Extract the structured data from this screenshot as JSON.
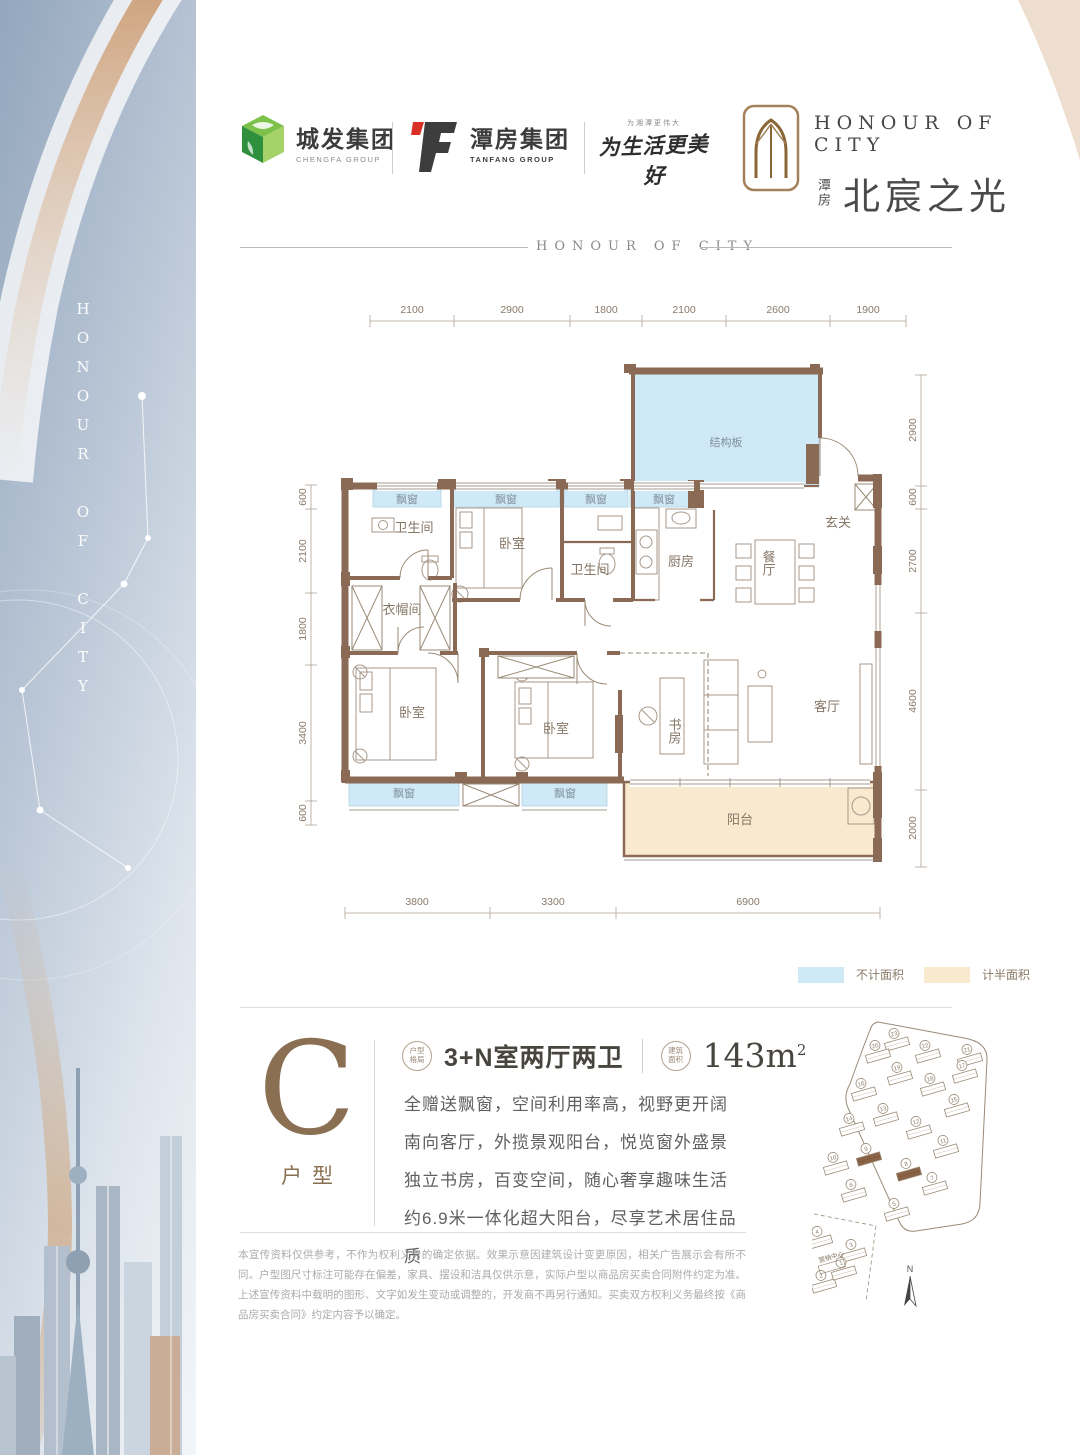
{
  "left_band": {
    "vertical_text": "HONOUR OF CITY"
  },
  "header": {
    "chengfa_name": "城发集团",
    "chengfa_sub": "CHENGFA GROUP",
    "tanfang_name": "潭房集团",
    "tanfang_sub": "TANFANG GROUP",
    "slogan_top": "为湘潭更伟大",
    "slogan_main": "为生活更美好",
    "brand_en": "HONOUR OF CITY",
    "brand_cn_small": "潭房",
    "brand_cn": "北宸之光"
  },
  "divider_text": "HONOUR OF CITY",
  "floorplan": {
    "rooms": {
      "struct": "结构板",
      "entry": "玄关",
      "bay": "飘窗",
      "bath": "卫生间",
      "bedroom": "卧室",
      "kitchen": "厨房",
      "dining": "餐厅",
      "cloak": "衣帽间",
      "study": "书房",
      "living": "客厅",
      "balcony": "阳台"
    },
    "dims": {
      "top": [
        "2100",
        "2900",
        "1800",
        "2100",
        "2600",
        "1900"
      ],
      "left": [
        "600",
        "2100",
        "1800",
        "3400",
        "600"
      ],
      "right": [
        "2900",
        "600",
        "2700",
        "4600",
        "2000"
      ],
      "bottom": [
        "3800",
        "3300",
        "6900"
      ]
    },
    "legend": {
      "blue": "不计面积",
      "beige": "计半面积"
    },
    "colors": {
      "wall": "#8a6a55",
      "no_area": "#cfe9f6",
      "half_area": "#f9e9ce"
    }
  },
  "info": {
    "type_letter": "C",
    "type_label": "户型",
    "badge1_line1": "户型",
    "badge1_line2": "格局",
    "layout": "3+N室两厅两卫",
    "badge2_line1": "建筑",
    "badge2_line2": "面积",
    "area_value": "143m",
    "area_sup": "2",
    "desc_lines": [
      "全赠送飘窗，空间利用率高，视野更开阔",
      "南向客厅，外揽景观阳台，悦览窗外盛景",
      "独立书房，百变空间，随心奢享趣味生活",
      "约6.9米一体化超大阳台，尽享艺术居住品质"
    ]
  },
  "disclaimer": "本宣传资料仅供参考，不作为权利义务的确定依据。效果示意因建筑设计变更原因，相关广告展示会有所不同。户型图尺寸标注可能存在偏差，家具、摆设和洁具仅供示意，实际户型以商品房买卖合同附件约定为准。上述宣传资料中载明的图形、文字如发生变动或调整的，开发商不再另行通知。买卖双方权利义务最终按《商品房买卖合同》约定内容予以确定。",
  "siteplan": {
    "north_label": "N",
    "marketing_label": "营销中心",
    "highlight_color": "#8a6347",
    "buildings": [
      {
        "n": "23",
        "x": 85,
        "y": 32
      },
      {
        "n": "22",
        "x": 116,
        "y": 44
      },
      {
        "n": "21",
        "x": 158,
        "y": 48
      },
      {
        "n": "20",
        "x": 66,
        "y": 44
      },
      {
        "n": "19",
        "x": 88,
        "y": 66
      },
      {
        "n": "18",
        "x": 121,
        "y": 77
      },
      {
        "n": "17",
        "x": 153,
        "y": 64
      },
      {
        "n": "16",
        "x": 52,
        "y": 82
      },
      {
        "n": "15",
        "x": 145,
        "y": 98
      },
      {
        "n": "14",
        "x": 40,
        "y": 117
      },
      {
        "n": "13",
        "x": 74,
        "y": 107
      },
      {
        "n": "12",
        "x": 107,
        "y": 120
      },
      {
        "n": "11",
        "x": 134,
        "y": 139
      },
      {
        "n": "10",
        "x": 24,
        "y": 156
      },
      {
        "n": "9",
        "x": 57,
        "y": 147,
        "brown": true
      },
      {
        "n": "8",
        "x": 97,
        "y": 162,
        "brown": true
      },
      {
        "n": "7",
        "x": 123,
        "y": 176
      },
      {
        "n": "6",
        "x": 42,
        "y": 183
      },
      {
        "n": "5",
        "x": 85,
        "y": 202
      },
      {
        "n": "4",
        "x": 8,
        "y": 230
      },
      {
        "n": "3",
        "x": 42,
        "y": 243
      },
      {
        "n": "2",
        "x": 12,
        "y": 274
      },
      {
        "n": "1",
        "x": 32,
        "y": 261
      }
    ]
  }
}
